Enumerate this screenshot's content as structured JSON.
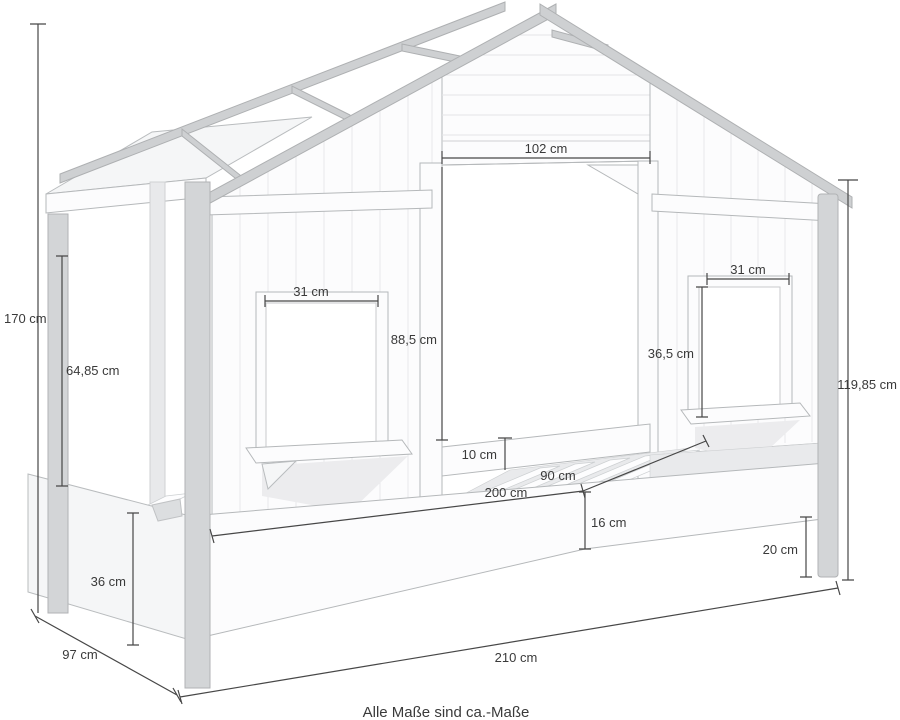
{
  "diagram": {
    "title": "house-bed-dimension-drawing",
    "note": "Alle Maße sind ca.-Maße",
    "dimensions": {
      "total_height": {
        "value": "170",
        "unit": "cm",
        "label": "170 cm"
      },
      "depth": {
        "value": "97",
        "unit": "cm",
        "label": "97 cm"
      },
      "total_length": {
        "value": "210",
        "unit": "cm",
        "label": "210 cm"
      },
      "roof_edge_height": {
        "value": "119,85",
        "unit": "cm",
        "label": "119,85 cm"
      },
      "entry_width": {
        "value": "102",
        "unit": "cm",
        "label": "102 cm"
      },
      "entry_height": {
        "value": "88,5",
        "unit": "cm",
        "label": "88,5 cm"
      },
      "window_left_width": {
        "value": "31",
        "unit": "cm",
        "label": "31 cm"
      },
      "window_right_width": {
        "value": "31",
        "unit": "cm",
        "label": "31 cm"
      },
      "window_right_height": {
        "value": "36,5",
        "unit": "cm",
        "label": "36,5 cm"
      },
      "canopy_height": {
        "value": "64,85",
        "unit": "cm",
        "label": "64,85 cm"
      },
      "guard_rail_height": {
        "value": "10",
        "unit": "cm",
        "label": "10 cm"
      },
      "lying_width": {
        "value": "90",
        "unit": "cm",
        "label": "90 cm"
      },
      "lying_length": {
        "value": "200",
        "unit": "cm",
        "label": "200 cm"
      },
      "frame_height": {
        "value": "16",
        "unit": "cm",
        "label": "16 cm"
      },
      "leg_height": {
        "value": "20",
        "unit": "cm",
        "label": "20 cm"
      },
      "clearance_height": {
        "value": "36",
        "unit": "cm",
        "label": "36 cm"
      }
    },
    "colors": {
      "background": "#ffffff",
      "outline": "#b5b8ba",
      "beam_fill": "#ced0d2",
      "wall_fill": "#fcfcfd",
      "dimension_line": "#474747",
      "text": "#3a3a3a"
    }
  }
}
